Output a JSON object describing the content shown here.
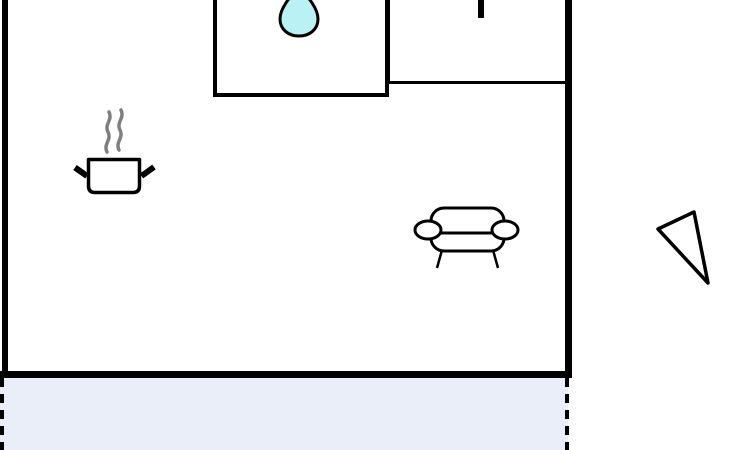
{
  "title": "top-down-room-floorplan",
  "colors": {
    "wall": "#000000",
    "outline": "#000000",
    "steam": "#7f7f7f",
    "sink_water": "#b9f1f4",
    "zone_fill": "#e9eef8",
    "background": "#ffffff"
  },
  "room": {
    "walls": [
      "left",
      "right",
      "bottom"
    ],
    "fixtures": [
      {
        "name": "sink-counter",
        "icon": "water-drop-icon"
      },
      {
        "name": "side-counter",
        "icon": "fixture-mark"
      }
    ],
    "objects": [
      {
        "name": "cooking-pot-icon",
        "detail": "steam-icon"
      },
      {
        "name": "sofa-icon"
      }
    ],
    "zone": {
      "name": "highlighted-floor-zone",
      "border": "dashed"
    },
    "outside": [
      {
        "name": "view-cone-icon"
      }
    ]
  }
}
